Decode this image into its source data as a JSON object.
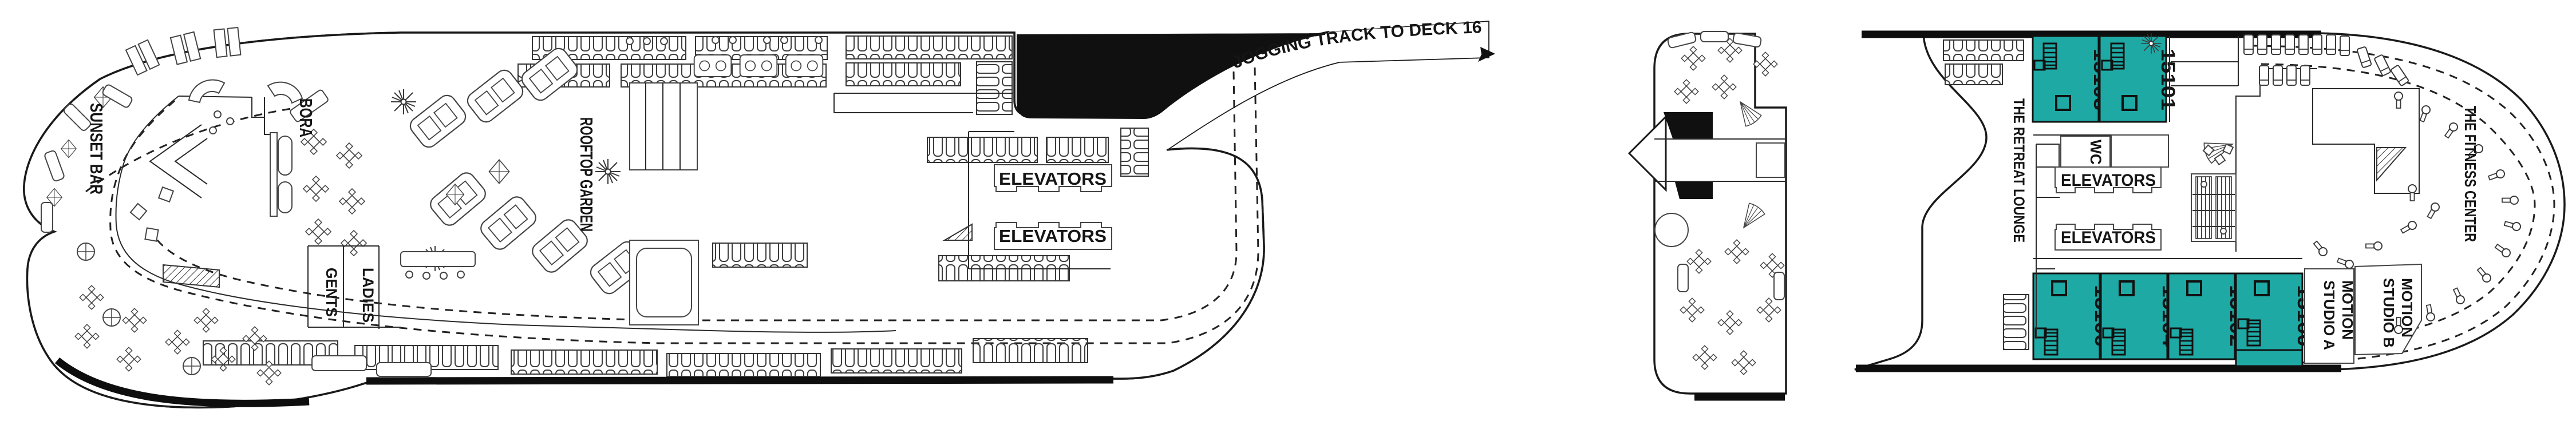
{
  "deck": {
    "jogging_track": {
      "label": "JOGGING TRACK TO DECK 16"
    },
    "left_section": {
      "sunset_bar": "SUNSET BAR",
      "bora": "BORA",
      "rooftop_garden": "ROOFTOP GARDEN",
      "ladies": "LADIES",
      "gents": "GENTS",
      "elevators": "ELEVATORS"
    },
    "right_section": {
      "retreat_lounge": "THE RETREAT LOUNGE",
      "wc": "WC",
      "elevators": "ELEVATORS",
      "fitness_center": "THE FITNESS CENTER",
      "motion_studio_line1": "MOTION",
      "motion_studio_a_line2": "STUDIO A",
      "motion_studio_b_line2": "STUDIO B",
      "cabins": {
        "top_row": [
          {
            "number": "15103"
          },
          {
            "number": "15101"
          }
        ],
        "bottom_row": [
          {
            "number": "15106"
          },
          {
            "number": "15104"
          },
          {
            "number": "15102"
          },
          {
            "number": "15100"
          }
        ]
      }
    },
    "colors": {
      "cabin_teal": "#1FA9A4",
      "line": "#1a1a1a"
    }
  }
}
